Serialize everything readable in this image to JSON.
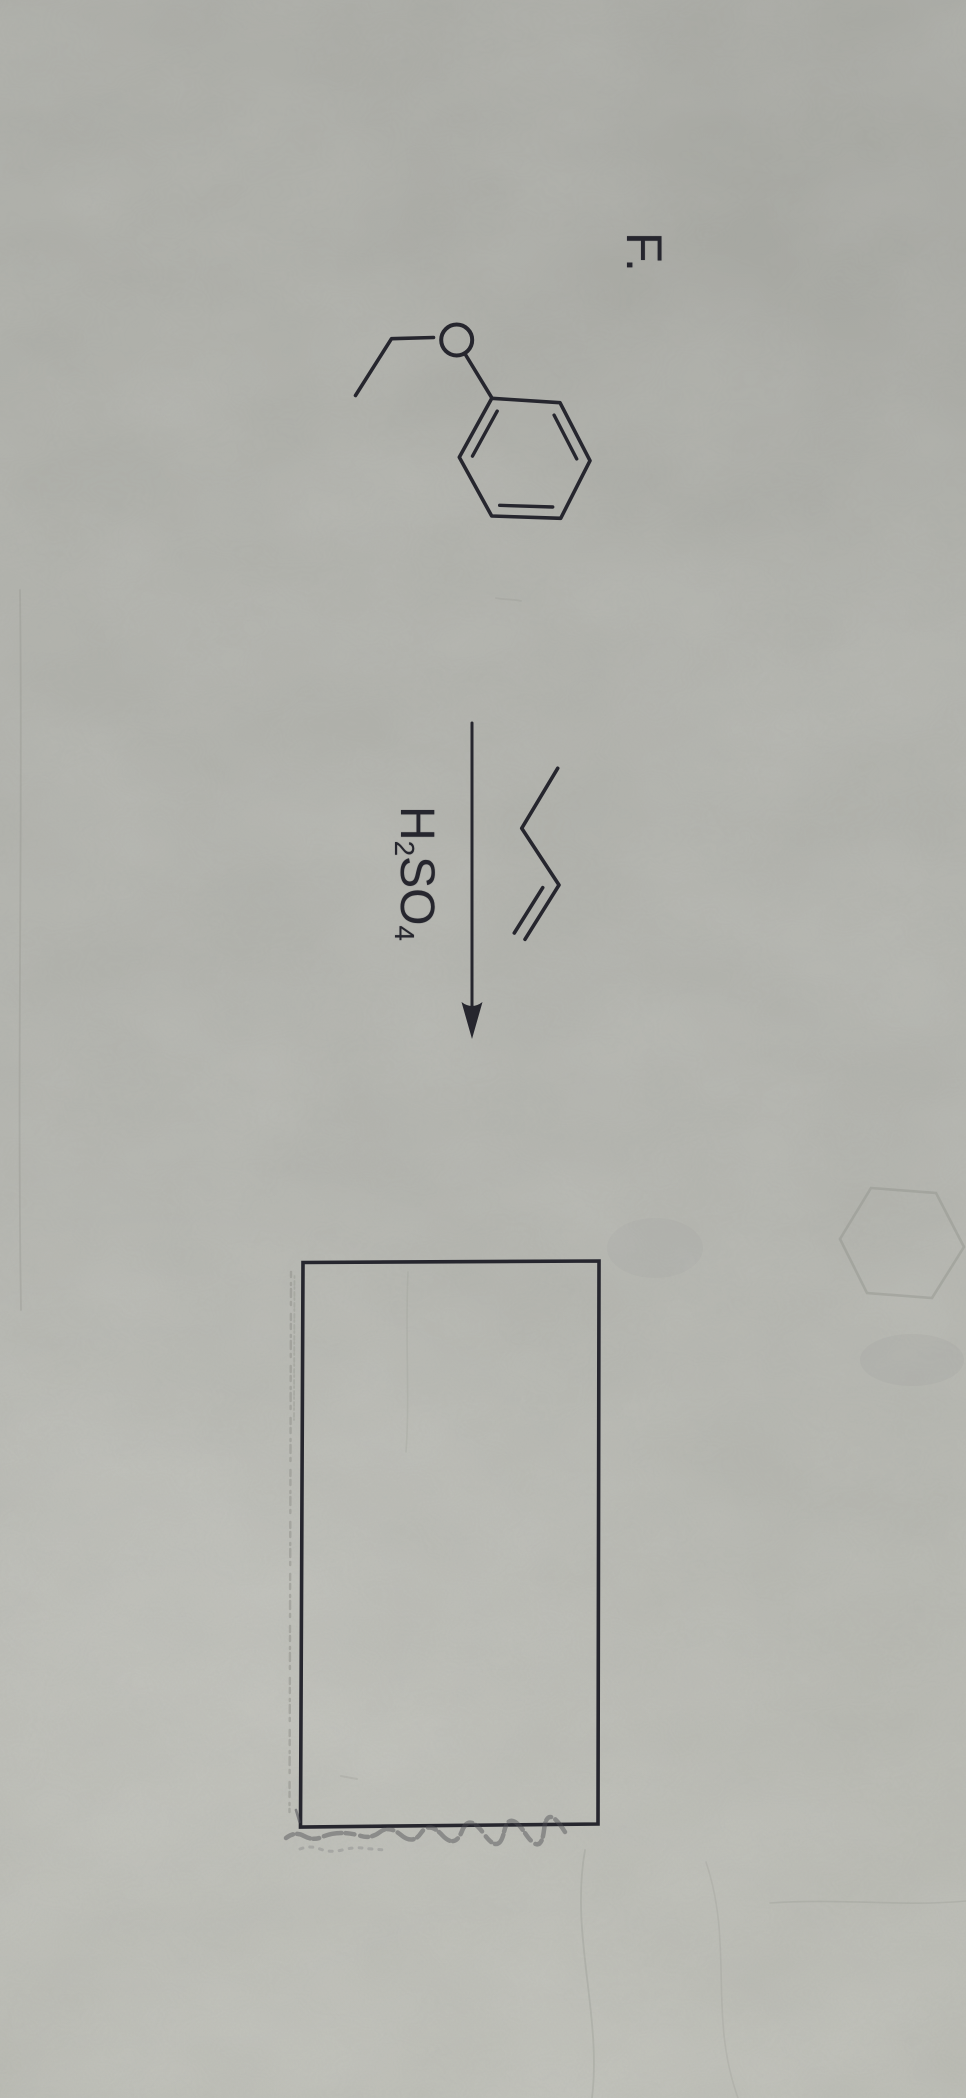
{
  "colors": {
    "paper": "#b1b2ab",
    "ink": "#26262e",
    "bleed": "#8d8e87",
    "smudge": "#4d4d53"
  },
  "labels": {
    "problem": "F."
  },
  "reagent": {
    "h": "H",
    "h_count": "2",
    "so": "SO",
    "o_count": "4"
  },
  "drawings": {
    "reactant": "ethoxybenzene skeletal structure",
    "reagent_structure": "but-1-ene skeletal structure",
    "arrow": "downward reaction arrow",
    "answer_box": "empty rectangular answer box"
  }
}
